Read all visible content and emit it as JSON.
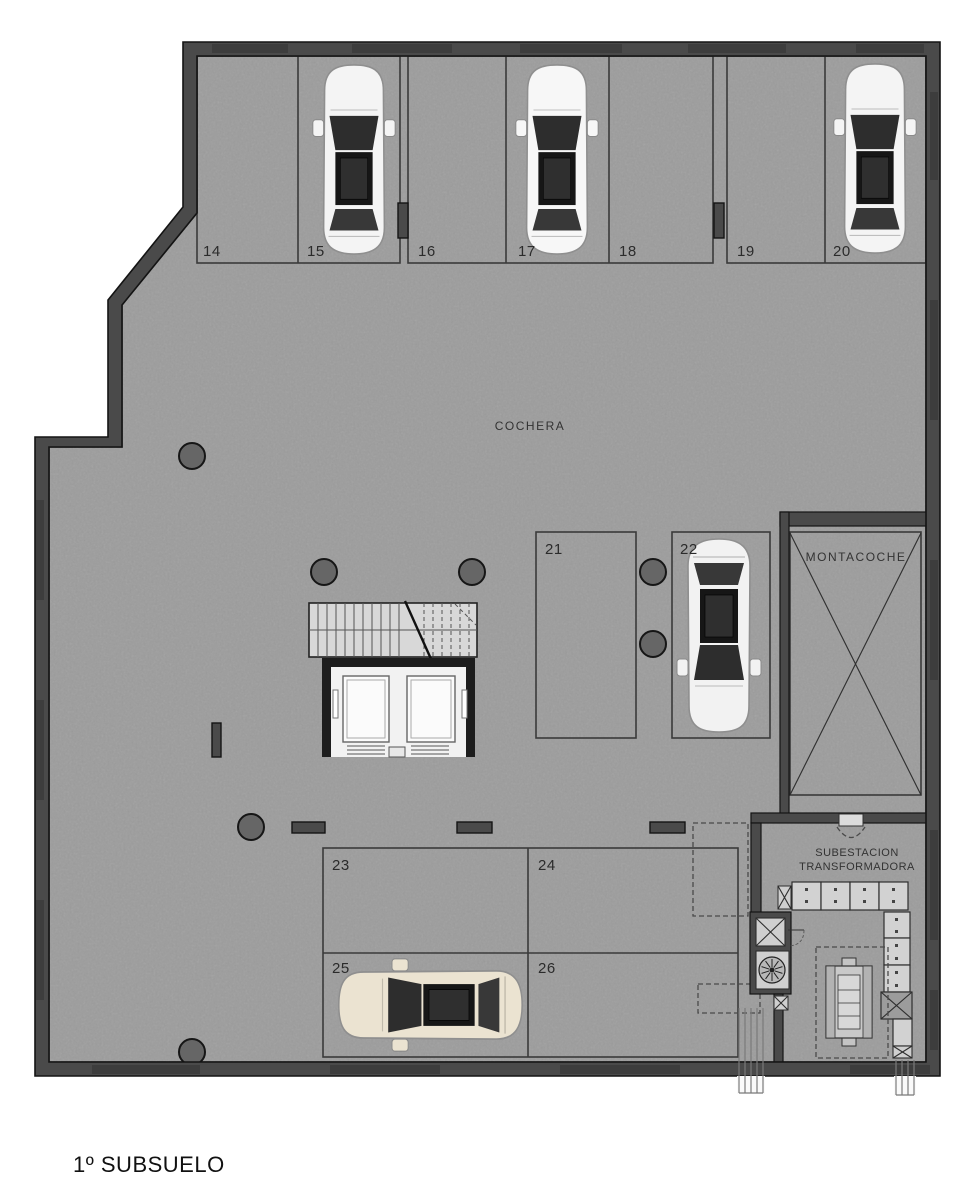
{
  "title": "1º SUBSUELO",
  "plan": {
    "room_label": "COCHERA",
    "car_lift_label": "MONTACOCHE",
    "substation_label": [
      "SUBESTACION",
      "TRANSFORMADORA"
    ],
    "stalls": [
      {
        "number": "14",
        "occupied": false
      },
      {
        "number": "15",
        "occupied": true
      },
      {
        "number": "16",
        "occupied": false
      },
      {
        "number": "17",
        "occupied": true
      },
      {
        "number": "18",
        "occupied": false
      },
      {
        "number": "19",
        "occupied": false
      },
      {
        "number": "20",
        "occupied": true
      },
      {
        "number": "21",
        "occupied": false
      },
      {
        "number": "22",
        "occupied": true
      },
      {
        "number": "23",
        "occupied": false
      },
      {
        "number": "24",
        "occupied": false
      },
      {
        "number": "25",
        "occupied": true
      },
      {
        "number": "26",
        "occupied": false
      }
    ],
    "cars": [
      {
        "stall": "15",
        "color": "#f4f4f4"
      },
      {
        "stall": "17",
        "color": "#f7f7f7"
      },
      {
        "stall": "20",
        "color": "#f4f4f4"
      },
      {
        "stall": "22",
        "color": "#f2f2f2"
      },
      {
        "stall": "25",
        "color": "#ebe3d1"
      }
    ],
    "colors": {
      "floor": "#9c9c9c",
      "wall": "#4a4a4a",
      "line": "#3a3a3a",
      "column": "#666666",
      "stairs": "#d8d8d8",
      "panel": "#d2d2d2",
      "text": "#2b2b2b"
    }
  }
}
